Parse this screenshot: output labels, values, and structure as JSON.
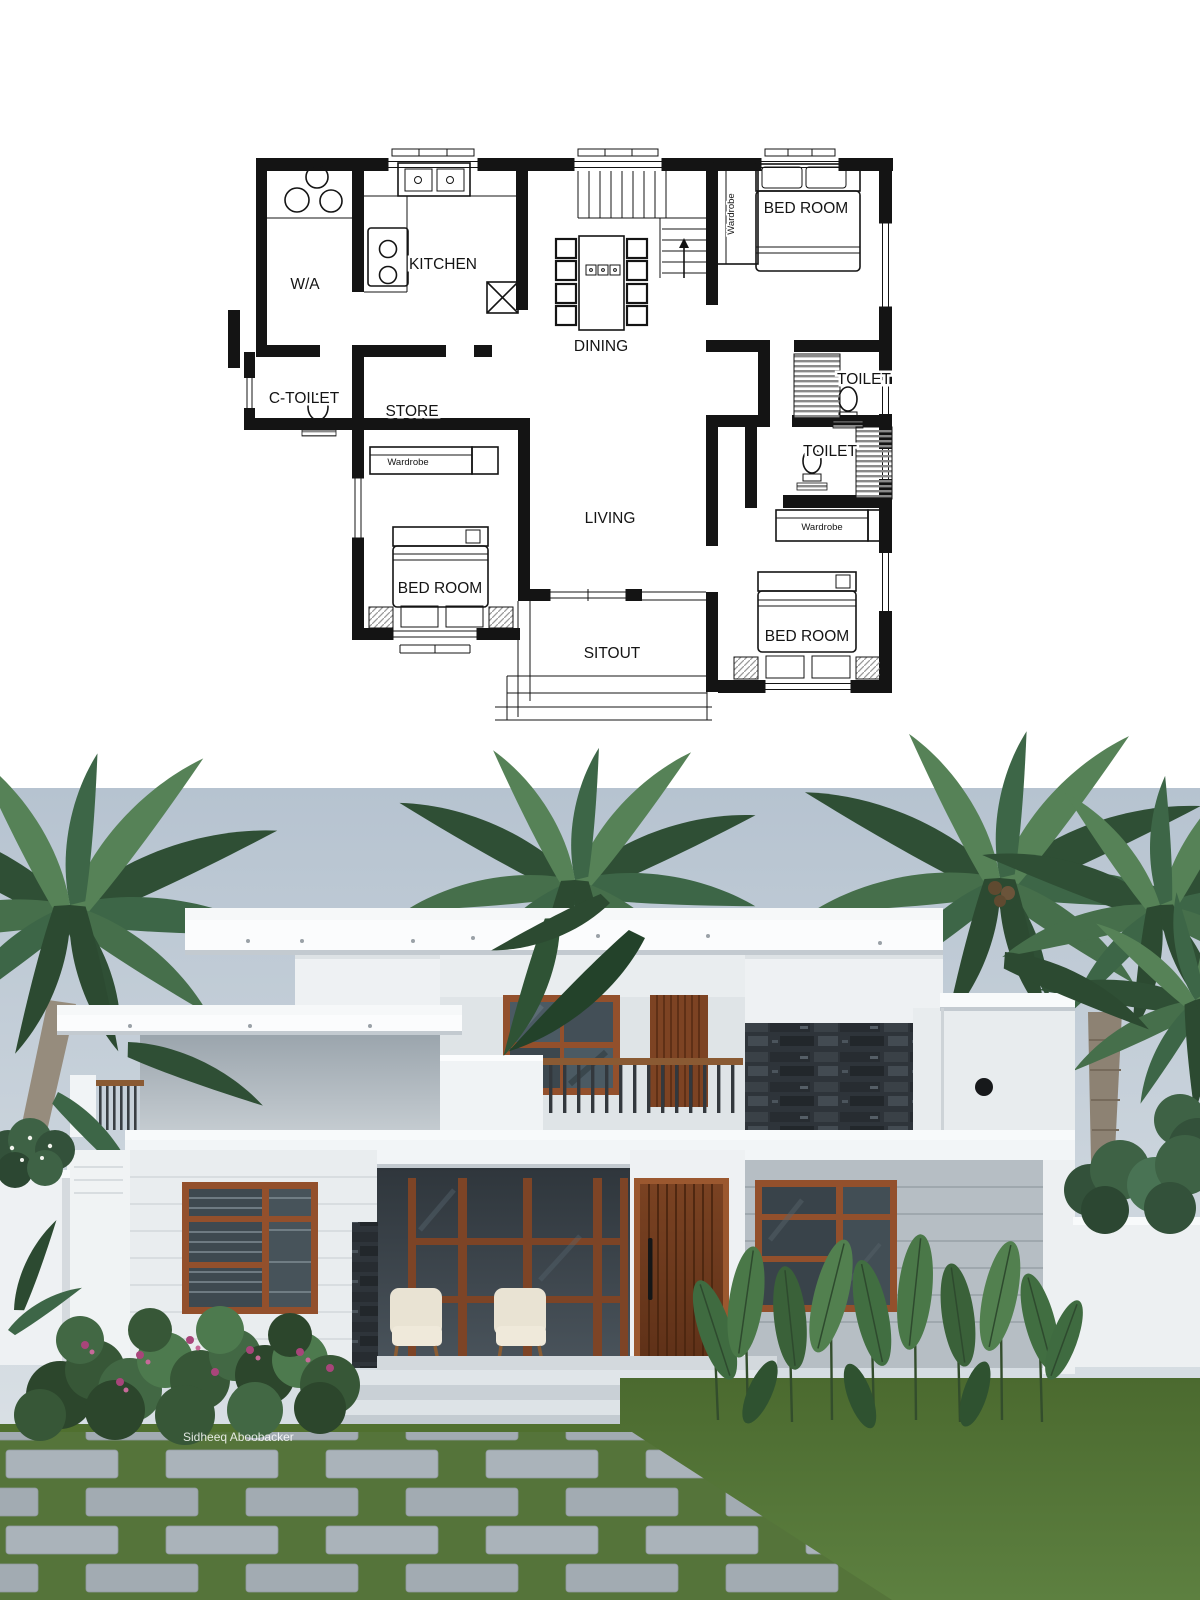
{
  "floor_plan": {
    "room_labels": {
      "wa": "W/A",
      "kitchen": "KITCHEN",
      "dining": "DINING",
      "bedroom_top_right": "BED ROOM",
      "c_toilet": "C-TOILET",
      "store": "STORE",
      "toilet_upper": "TOILET",
      "toilet_lower": "TOILET",
      "living": "LIVING",
      "bedroom_left": "BED ROOM",
      "sitout": "SITOUT",
      "bedroom_bottom_right": "BED ROOM",
      "wardrobe_stairs": "Wardrobe",
      "wardrobe_store": "Wardrobe",
      "wardrobe_right": "Wardrobe"
    },
    "line_color": "#141414"
  },
  "render": {
    "watermark": "Sidheeq Aboobacker",
    "colors": {
      "sky_top": "#b6c3d0",
      "sky_bottom": "#e2e7ea",
      "wall_white": "#f1f4f6",
      "wall_gray": "#a9b2b9",
      "siding_gray": "#b6bec4",
      "stone_dark": "#2e343a",
      "wood_frame": "#93502c",
      "door_wood": "#6e3a1e",
      "glass": "#3a454c",
      "lawn_green": "#527434",
      "paver_gray": "#aab3ba",
      "palm_green": "#3d6647",
      "railing_dark": "#33383d"
    }
  }
}
